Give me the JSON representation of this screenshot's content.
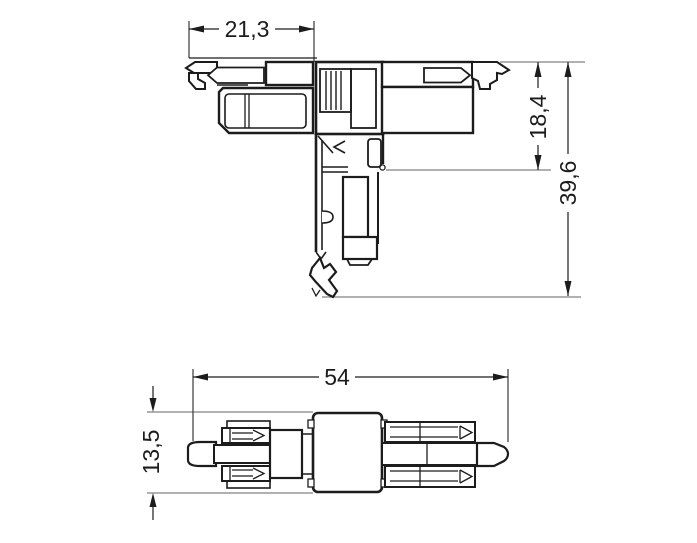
{
  "drawing": {
    "colors": {
      "background": "#ffffff",
      "outline": "#1c1c1c",
      "extension_line": "#828282"
    },
    "dimensions": {
      "front_width": "21,3",
      "front_depth_upper": "18,4",
      "front_depth_total": "39,6",
      "side_length": "54",
      "side_height": "13,5"
    }
  }
}
